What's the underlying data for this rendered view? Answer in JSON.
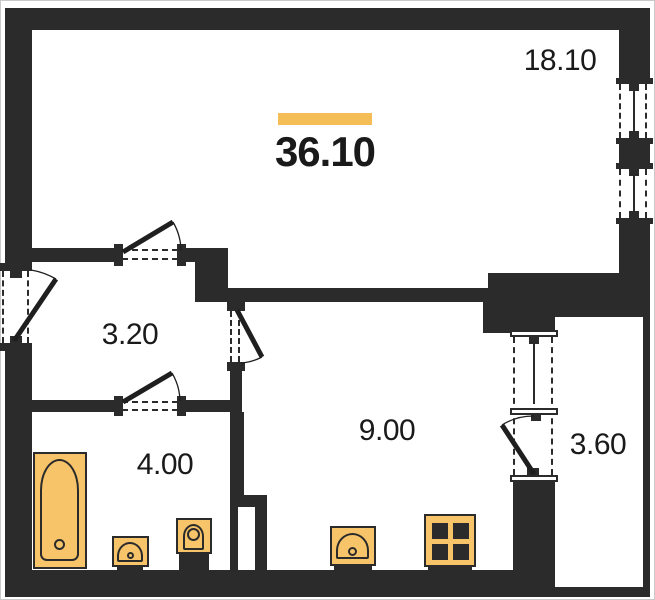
{
  "floor_plan": {
    "total_area": {
      "value": "36.10"
    },
    "rooms": {
      "living": {
        "area": "18.10"
      },
      "hallway": {
        "area": "3.20"
      },
      "bathroom": {
        "area": "4.00"
      },
      "kitchen": {
        "area": "9.00"
      },
      "balcony": {
        "area": "3.60"
      }
    },
    "fixtures": {
      "bathtub": "bathtub-icon",
      "bathroom_sink": "sink-icon",
      "toilet": "toilet-icon",
      "kitchen_sink": "kitchen-sink-icon",
      "stove": "stove-icon"
    },
    "colors": {
      "wall": "#2b2b2b",
      "fixture_fill": "#f7c469",
      "fixture_border": "#2b2b2b",
      "accent_bar": "#f5bd55",
      "label_text": "#1a1a1a",
      "background": "#ffffff"
    }
  }
}
